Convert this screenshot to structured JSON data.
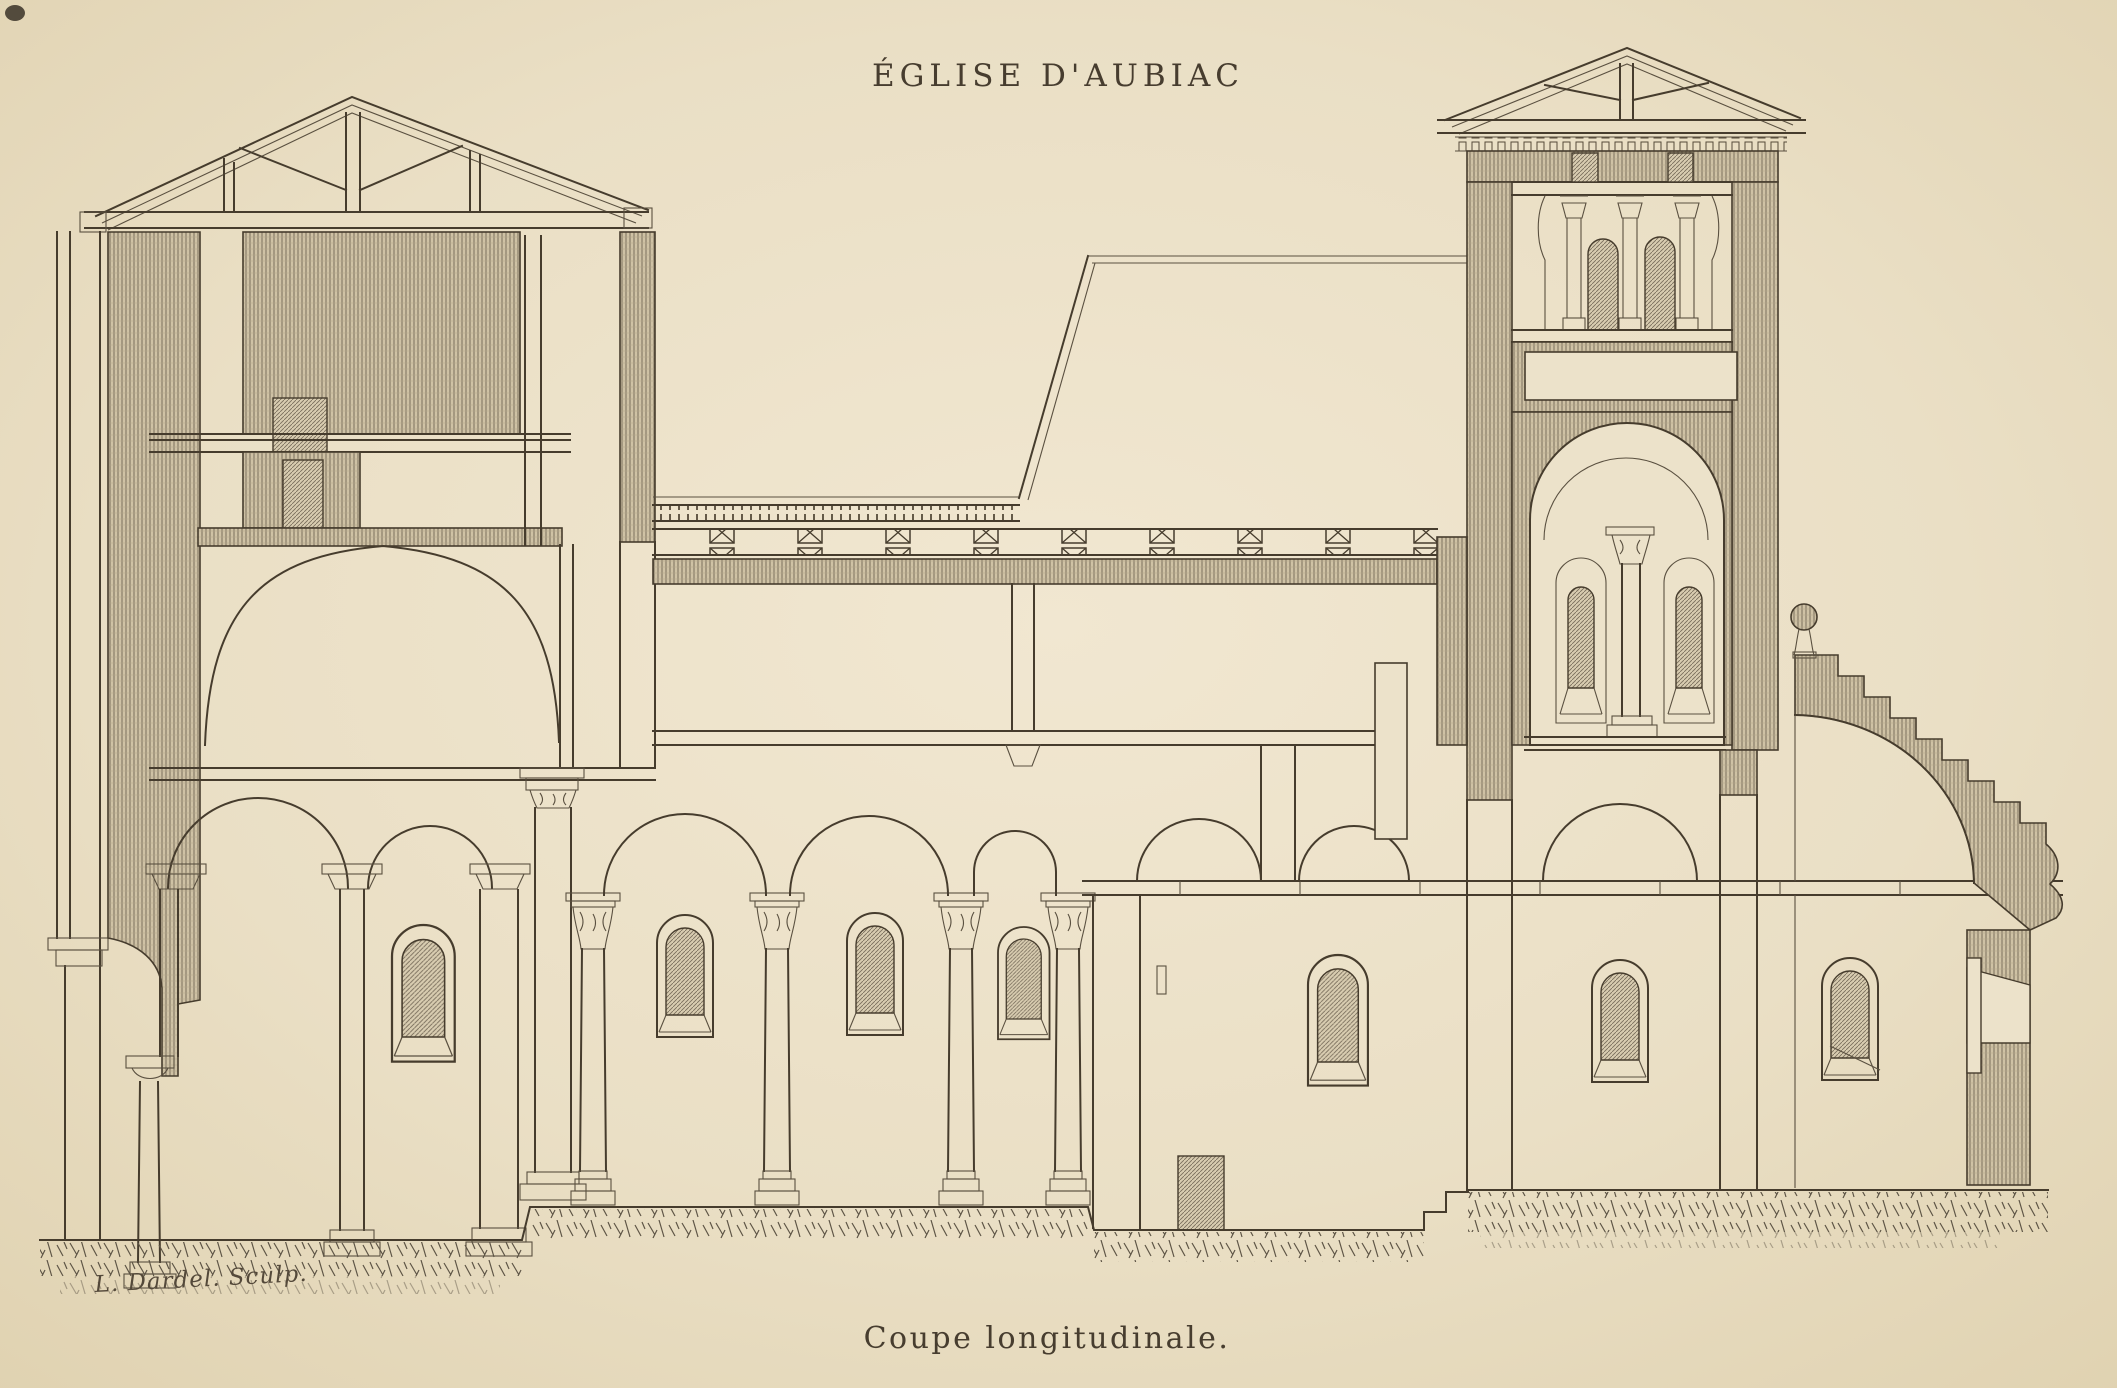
{
  "plate": {
    "title": "ÉGLISE D'AUBIAC",
    "caption": "Coupe longitudinale.",
    "signature": "L. Dardel. Sculp.",
    "drawing_type": "engraved longitudinal section of a church",
    "colors": {
      "paper": "#eadfc5",
      "ink": "#463c2d",
      "hatch_fill": "#cfc2a5",
      "hatch_line": "#6f6454",
      "grass": "#5e5546"
    }
  }
}
